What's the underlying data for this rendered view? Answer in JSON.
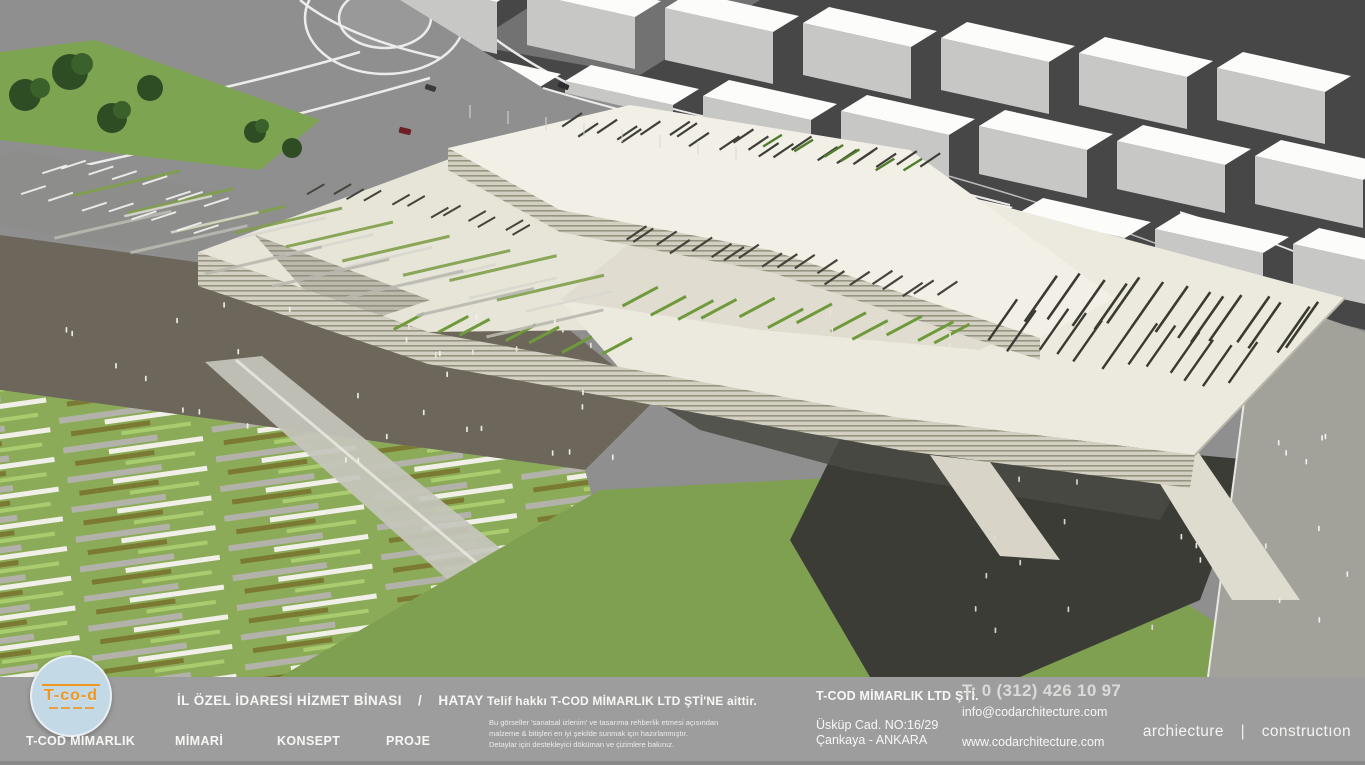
{
  "footer": {
    "logo": {
      "mark": "T-co-d",
      "brand": "T-COD MİMARLIK"
    },
    "project": {
      "title": "İL ÖZEL İDARESİ HİZMET BİNASI",
      "separator": "/",
      "location": "HATAY"
    },
    "menu": {
      "items": [
        {
          "label": "MİMARİ"
        },
        {
          "label": "KONSEPT"
        },
        {
          "label": "PROJE"
        }
      ]
    },
    "copyright": {
      "line": "Telif hakkı T-COD MİMARLIK LTD ŞTİ'NE aittir.",
      "disclaimer_line1": "Bu görseller 'sanatsal izlenim' ve tasarıma rehberlik etmesi açısından",
      "disclaimer_line2": "malzeme & bitişleri en iyi şekilde sunmak için hazırlanmıştır.",
      "disclaimer_line3": "Detaylar için destekleyici döküman ve çizimlere bakınız."
    },
    "company": {
      "name": "T-COD MİMARLIK LTD ŞTİ.",
      "address_line1": "Üsküp Cad. NO:16/29",
      "address_line2": "Çankaya - ANKARA"
    },
    "contact": {
      "phone": "T: 0 (312) 426 10 97",
      "email": "info@codarchitecture.com",
      "website": "www.codarchitecture.com"
    },
    "tagline": {
      "left": "archiecture",
      "divider": "|",
      "right": "constructıon"
    }
  },
  "colors": {
    "footer_bg": "#9d9d9d",
    "logo_circle": "#c3d9e5",
    "logo_orange": "#f0971e",
    "building_cream": "#ece9de",
    "grass_green": "#7fa050",
    "stripe_olive": "#7b7a33",
    "stripe_light_green": "#a9cc6e",
    "asphalt_dark": "#474747"
  }
}
